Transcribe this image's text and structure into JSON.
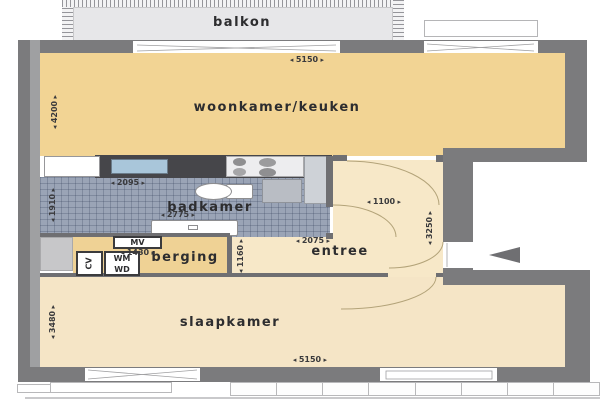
{
  "type": "floor-plan",
  "language": "nl",
  "rooms": {
    "balcony": "balkon",
    "living": "woonkamer/keuken",
    "bath": "badkamer",
    "storage": "berging",
    "hall": "entree",
    "bedroom": "slaapkamer"
  },
  "units": {
    "ventilation": "MV",
    "washer": "WM",
    "dryer": "WD",
    "heater": "CV"
  },
  "dimensions_mm": {
    "living_top_width": "5150",
    "bedroom_bottom_width": "5150",
    "kitchen_counter_width": "2095",
    "bathroom_width": "2775",
    "storage_width": "1430",
    "hall_door_width": "1100",
    "hall_width": "2075",
    "living_height": "4200",
    "bathroom_height": "1910",
    "bedroom_height": "3480",
    "hall_height": "3250",
    "storage_height": "1160"
  },
  "colors": {
    "wall": "#7b7b7d",
    "living_floor": "#f2d494",
    "hall_floor": "#f7e8c8",
    "storage_floor": "#efd295",
    "bedroom_floor": "#f5e5c6",
    "bath_tiles": "#9aa4b6",
    "balcony_floor": "#e7e7e9",
    "kitchen_counter": "#46464a",
    "kitchen_sink": "#a9c6da"
  }
}
